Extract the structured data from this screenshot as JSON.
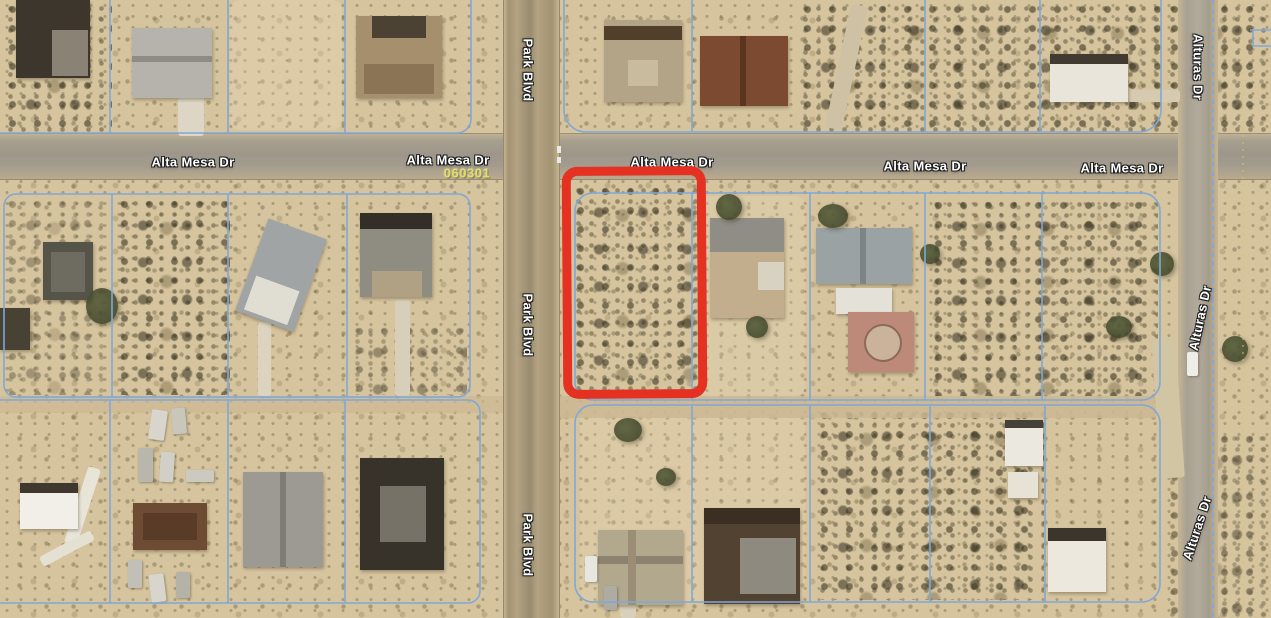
{
  "map": {
    "roads": {
      "alta_mesa": {
        "label": "Alta Mesa Dr"
      },
      "park_blvd": {
        "label": "Park Blvd"
      },
      "alturas": {
        "label": "Alturas Dr"
      }
    },
    "annotations": {
      "parcel_number": "060301"
    },
    "colors": {
      "highlight_outline_red": "#e53122",
      "parcel_line_blue": "#7fa8d8",
      "road_label_white": "#ffffff",
      "parcel_number_yellow": "#e4de62",
      "terrain_base_tan": "#d6c49e"
    }
  }
}
